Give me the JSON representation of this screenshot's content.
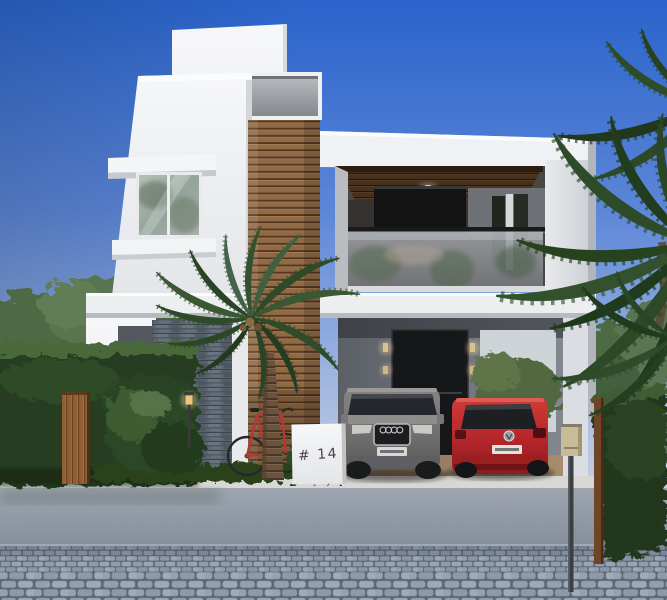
{
  "scene": {
    "house_number": "# 14",
    "objects": {
      "building": "modern-two-story-villa",
      "accent": "wooden-slat-column",
      "balcony": "glass-railing-balcony",
      "carport": "open-carport",
      "vehicle_1": "gray-suv",
      "vehicle_2": "red-hatchback",
      "tree_1": "front-palm-tree",
      "tree_2": "right-palm-tree",
      "fence": "boxwood-hedge",
      "gate": "wooden-gate",
      "bike": "red-bicycle",
      "street": "cobblestone-street"
    },
    "colors": {
      "sky_top": "#2a63cb",
      "sky_horizon": "#c6cfe0",
      "wall_white": "#f2f3f5",
      "wood_slats": "#8f6a45",
      "balcony_ceiling_wood": "#46311f",
      "stone_wall": "#6b7680",
      "hedge": "#2f4a2b",
      "palm_foliage": "#3a5833",
      "suv_gray": "#7b7977",
      "hatchback_red": "#c0272d",
      "gate_wood": "#925f35",
      "bicycle_red": "#b03a31",
      "sidewalk": "#8f96a1",
      "cobblestone": "#8c99a9",
      "carport_floor": "#93785c"
    }
  }
}
